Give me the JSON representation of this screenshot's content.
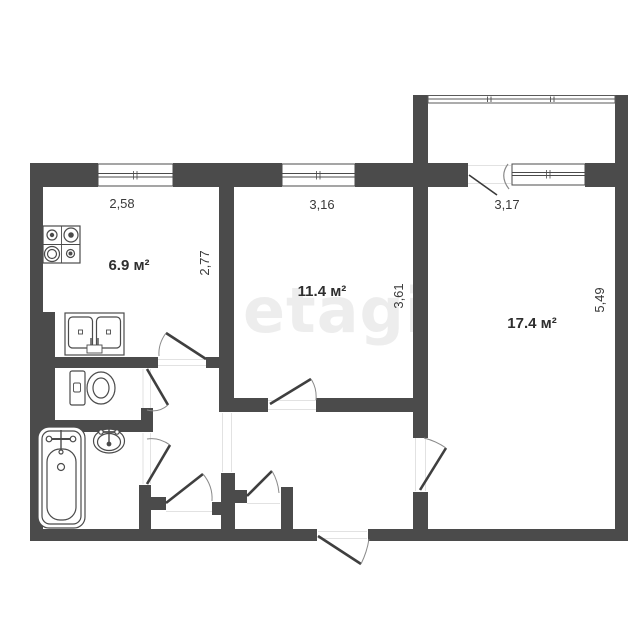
{
  "watermark": "etagi",
  "plan": {
    "rooms": [
      {
        "id": "kitchen",
        "area": "6.9 м²",
        "width_dim": "2,58",
        "height_dim": "2,77"
      },
      {
        "id": "room-medium",
        "area": "11.4 м²",
        "width_dim": "3,16",
        "height_dim": "3,61"
      },
      {
        "id": "room-large",
        "area": "17.4 м²",
        "width_dim": "3,17",
        "height_dim": "5,49"
      }
    ],
    "fixtures": [
      "stove-icon",
      "kitchen-sink-icon",
      "toilet-icon",
      "bathtub-icon",
      "washbasin-icon"
    ],
    "colors": {
      "wall": "#4b4b4b",
      "line": "#555555",
      "dim_text": "#3a3a3a",
      "watermark": "#ededed"
    }
  }
}
